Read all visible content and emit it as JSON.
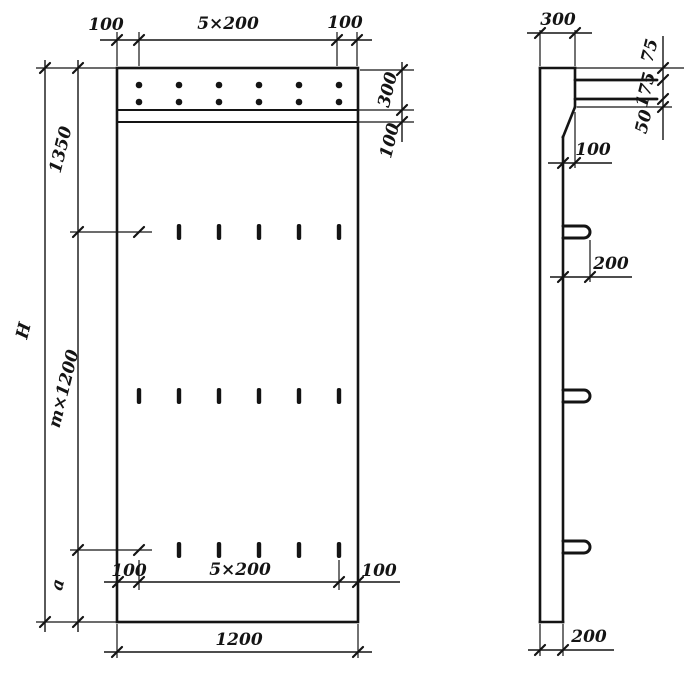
{
  "front_view": {
    "top_dims": {
      "left": "100",
      "middle": "5×200",
      "right": "100"
    },
    "left_dims": {
      "overall": "H",
      "upper": "1350",
      "middle": "m×1200",
      "lower": "a"
    },
    "right_dims": {
      "band": "300",
      "strip": "100"
    },
    "lower_dims": {
      "left": "100",
      "middle": "5×200",
      "right": "100"
    },
    "bottom_dims": {
      "width": "1200"
    },
    "features": {
      "anchor_dot_rows": 2,
      "anchor_dots_per_row": 6,
      "slot_rows": 3,
      "slots_per_row": 6
    }
  },
  "side_view": {
    "top_dim": "300",
    "right_dims": {
      "upper": "75",
      "middle": "175",
      "lower": "50"
    },
    "bend_dim": "100",
    "hook_dim": "200",
    "bottom_dim": "200",
    "features": {
      "hooks": 3,
      "bolt_rows": 2
    }
  },
  "colors": {
    "ink": "#141414",
    "paper": "#ffffff"
  }
}
